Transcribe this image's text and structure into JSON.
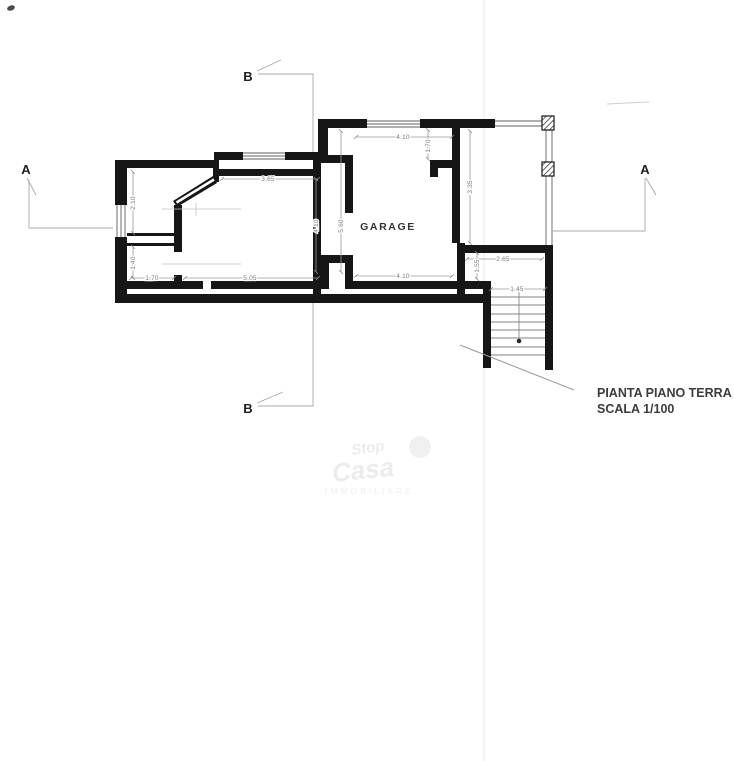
{
  "titleblock": {
    "line1": "PIANTA PIANO TERRA",
    "line2": "SCALA 1/100"
  },
  "rooms": {
    "garage": "GARAGE"
  },
  "section_markers": {
    "a_left": "A",
    "a_right": "A",
    "b_top": "B",
    "b_bottom": "B"
  },
  "dimensions": {
    "living_top": "3.65",
    "room1_height": "2.10",
    "room2_height": "1.40",
    "room2_width": "1.70",
    "living_width": "5.05",
    "living_height": "4.10",
    "garage_depth": "5.60",
    "garage_width_top": "4.10",
    "garage_pier": "1.70",
    "garage_width_bottom": "4.10",
    "porch_depth": "3.35",
    "landing_width": "2.65",
    "landing_depth": "1.55",
    "stair_width": "1.45"
  },
  "watermark": {
    "word1": "Stop",
    "word2": "Casa",
    "word3": "IMMOBILIARE"
  },
  "colors": {
    "wall": "#161616",
    "window_line": "#5f5f5f",
    "dim_line": "#9a9a9a",
    "section_line": "#a8a8a8",
    "title_text": "#3c3c3c"
  }
}
